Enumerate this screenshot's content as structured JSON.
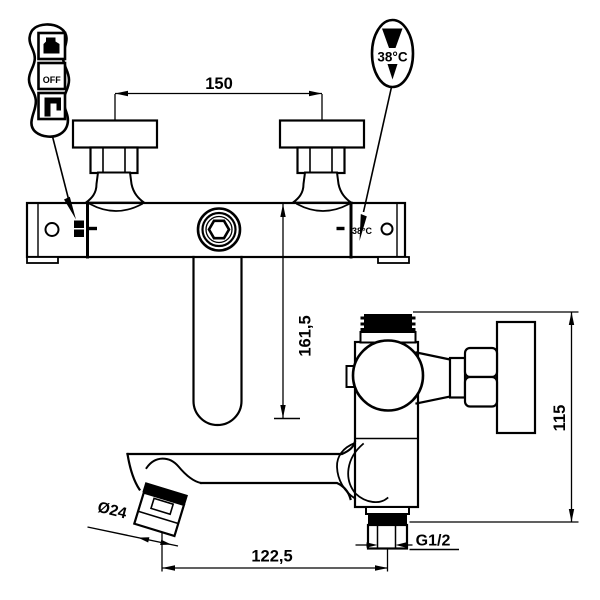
{
  "drawing": {
    "type": "technical-drawing",
    "subject": "wall-mounted thermostatic bath shower mixer",
    "colors": {
      "line": "#000000",
      "background": "#ffffff"
    },
    "front_view": {
      "center_distance_label": "150",
      "spout_height_label": "161,5",
      "temp_marking": "38°C"
    },
    "side_view": {
      "height_label": "115",
      "reach_label": "122,5",
      "outlet_thread_label": "G1/2",
      "aerator_diameter_label": "Ø24"
    },
    "callouts": {
      "mode_selector": {
        "top_icon": "shower-icon",
        "off_label": "OFF",
        "bottom_icon": "tap-icon"
      },
      "temperature": {
        "label": "38°C",
        "top_icon": "thermo-funnel-icon",
        "bottom_icon": "down-triangle-icon"
      }
    }
  }
}
